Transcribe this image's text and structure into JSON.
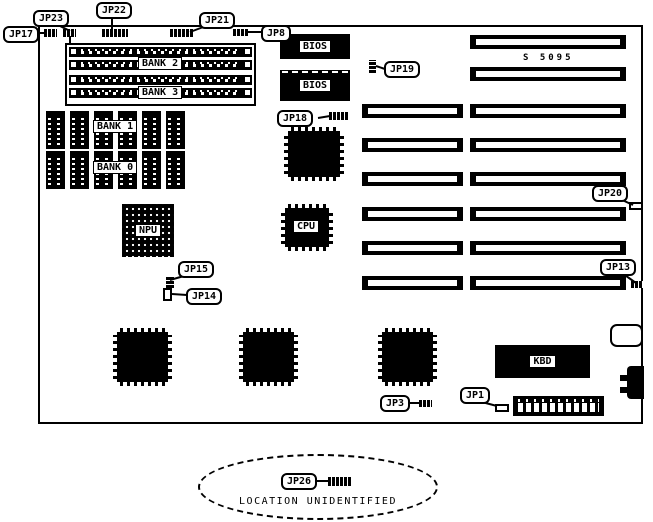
{
  "colors": {
    "foreground": "#000000",
    "background": "#ffffff"
  },
  "silkscreen": {
    "model": "S 5095"
  },
  "jumpers": {
    "jp17": "JP17",
    "jp23": "JP23",
    "jp22": "JP22",
    "jp21": "JP21",
    "jp8": "JP8",
    "jp19": "JP19",
    "jp18": "JP18",
    "jp20": "JP20",
    "jp13": "JP13",
    "jp15": "JP15",
    "jp14": "JP14",
    "jp3": "JP3",
    "jp1": "JP1",
    "jp26": "JP26"
  },
  "chips": {
    "bios_top": "BIOS",
    "bios_bottom": "BIOS",
    "bank2": "BANK 2",
    "bank3": "BANK 3",
    "bank1": "BANK 1",
    "bank0": "BANK 0",
    "npu": "NPU",
    "cpu": "CPU",
    "kbd": "KBD"
  },
  "note": {
    "location_label": "LOCATION UNIDENTIFIED"
  },
  "board": {
    "expansion_slot_rows": 8,
    "short_slot_rows": 6,
    "memory_chips_per_row": 6,
    "dip_rows": 2
  }
}
